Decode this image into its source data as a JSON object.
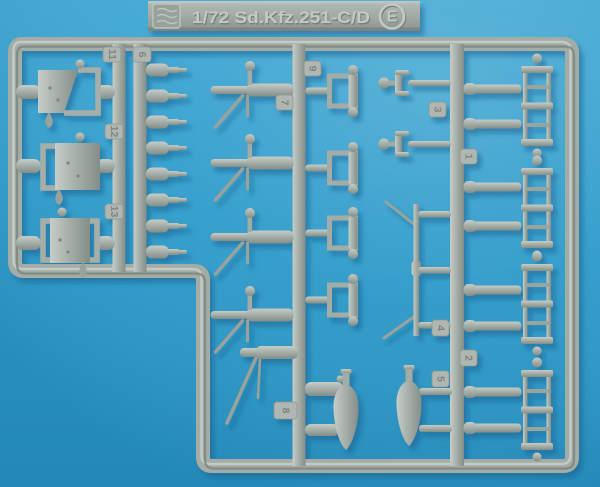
{
  "photo_subject": "injection-molded plastic model sprue on blue background",
  "colors": {
    "background_blue": "#2f9ccb",
    "plastic_gray": "#a6aea8",
    "plastic_highlight": "#c7cdc7",
    "plastic_shadow": "#7e8680",
    "cast_shadow": "#0e5d8c"
  },
  "label_bar": {
    "logo_icon": "manufacturer-logo",
    "scale_text": "1/72 Sd.Kfz.251-C/D",
    "sprue_letter": "E"
  },
  "part_numbers": {
    "tag_11": "11",
    "tag_6": "6",
    "tag_12": "12",
    "tag_13": "13",
    "tag_9": "9",
    "tag_7": "7",
    "tag_3": "3",
    "tag_1": "1",
    "tag_4": "4",
    "tag_2": "2",
    "tag_5": "5",
    "tag_8": "8"
  },
  "visible_parts": [
    "3 flat armored plates with ball and teardrop knobs",
    "8 gun barrels on inner runner",
    "5 machine guns with bipod legs",
    "4 rectangular mount brackets with twin balls",
    "2 ball-socket fittings",
    "1 long antenna pole with braces",
    "8 axle rods",
    "4 ladder-shaped frame parts with end balls",
    "2 teardrop bomb / fuel-tank shapes",
    "2 short stowage cylinders"
  ]
}
